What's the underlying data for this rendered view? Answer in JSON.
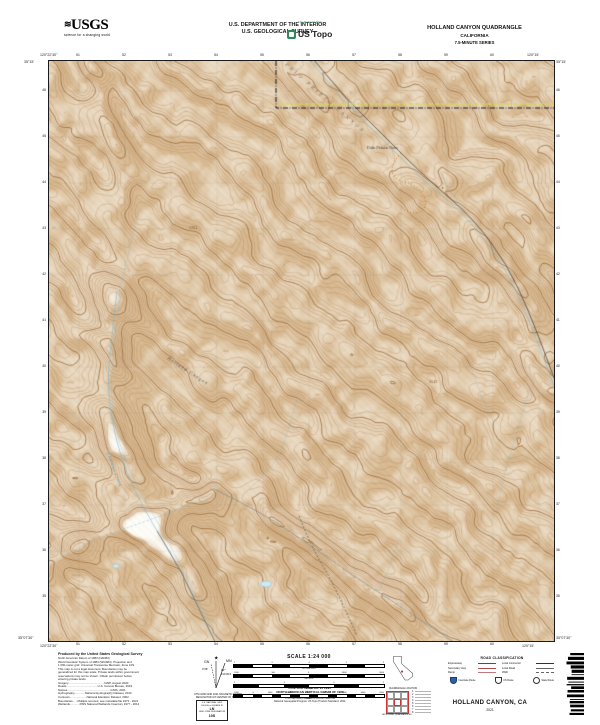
{
  "header": {
    "usgs_logo_text": "USGS",
    "usgs_tagline": "science for a changing world",
    "dept_line1": "U.S. DEPARTMENT OF THE INTERIOR",
    "dept_line2": "U.S. GEOLOGICAL SURVEY",
    "ustopo_brand_top": "The National Map",
    "ustopo_brand": "US Topo",
    "quad_title": "HOLLAND CANYON QUADRANGLE",
    "quad_state": "CALIFORNIA",
    "quad_series": "7.5-MINUTE SERIES"
  },
  "map": {
    "corner_nw_lon": "120°22'30\"",
    "corner_nw_lat": "35°15'",
    "corner_ne_lon": "120°15'",
    "corner_ne_lat": "35°15'",
    "corner_sw_lon": "120°22'30\"",
    "corner_sw_lat": "35°07'30\"",
    "corner_se_lon": "120°15'",
    "corner_se_lat": "35°07'30\"",
    "top_ticks": [
      "51",
      "52",
      "53",
      "54",
      "55",
      "56",
      "57",
      "58",
      "59",
      "60"
    ],
    "bottom_ticks": [
      "51",
      "52",
      "53",
      "54",
      "55",
      "56",
      "57",
      "58",
      "59",
      "60"
    ],
    "left_ticks": [
      "46",
      "45",
      "44",
      "43",
      "42",
      "41",
      "40",
      "39",
      "38",
      "37",
      "36",
      "35"
    ],
    "right_ticks": [
      "46",
      "45",
      "44",
      "43",
      "42",
      "41",
      "40",
      "39",
      "38",
      "37",
      "36",
      "35"
    ],
    "labels": [
      {
        "text": "PALO PRIETO CANYON",
        "x": 236,
        "y": 4,
        "rot": 41,
        "size": 4.2,
        "color": "#6b6b6b",
        "italic": true,
        "spacing": 3
      },
      {
        "text": "Palo Prieto Pass",
        "x": 318,
        "y": 88,
        "rot": 0,
        "size": 3.8,
        "color": "#333333",
        "italic": false,
        "spacing": 0
      },
      {
        "text": "Holland Canyon",
        "x": 118,
        "y": 298,
        "rot": 33,
        "size": 4.2,
        "color": "#555555",
        "italic": true,
        "spacing": 1
      },
      {
        "text": "Cholame Creek",
        "x": 58,
        "y": 392,
        "rot": 70,
        "size": 3.8,
        "color": "#4a88ab",
        "italic": true,
        "spacing": 0.5
      },
      {
        "text": "2113",
        "x": 380,
        "y": 322,
        "rot": 0,
        "size": 3.3,
        "color": "#7a4a22",
        "italic": false,
        "spacing": 0
      },
      {
        "text": "1762",
        "x": 140,
        "y": 168,
        "rot": 0,
        "size": 3.3,
        "color": "#7a4a22",
        "italic": false,
        "spacing": 0
      }
    ]
  },
  "footer": {
    "credits_lines": [
      "Produced by the United States Geological Survey",
      "North American Datum of 1983 (NAD83)",
      "World Geodetic System of 1984 (WGS84). Projection and",
      "1 000-meter grid: Universal Transverse Mercator, Zone 10S",
      "This map is not a legal document. Boundaries may be",
      "generalized for this map scale. Private lands within government",
      "reservations may not be shown. Obtain permission before",
      "entering private lands.",
      "Imagery.............................................NAIP, August 2020",
      "Roads.......................................U.S. Census Bureau, 2019",
      "Names......................................................GNIS, 2021",
      "Hydrography.............National Hydrography Dataset, 2013",
      "Contours.....................National Elevation Dataset, 2002",
      "Boundaries......Multiple sources; see metadata file 1972 - 2021",
      "Wetlands............FWS National Wetlands Inventory 1977 - 2014"
    ],
    "declination": {
      "star": "★",
      "mn_label": "MN",
      "mn_angle": "12°",
      "mn_mils": "213 MILS",
      "gn_label": "GN",
      "gn_angle": "0°28'",
      "caption1": "UTM GRID AND 2021 MAGNETIC NORTH",
      "caption2": "DECLINATION AT CENTER OF SHEET"
    },
    "usng": {
      "title1": "U.S. NATIONAL GRID",
      "title2": "100,000-m SQUARE ID",
      "square_id": "LN",
      "zone_label": "GRID ZONE DESIGNATION",
      "zone": "10S"
    },
    "scale": {
      "title": "SCALE 1:24 000",
      "bars": [
        {
          "unit": "KILOMETERS",
          "ticks": [
            "1",
            ".5",
            "0",
            "1",
            "2"
          ]
        },
        {
          "unit": "METERS",
          "ticks": [
            "1000",
            "500",
            "0",
            "1000",
            "2000"
          ]
        },
        {
          "unit": "MILES",
          "ticks": [
            "1",
            ".5",
            "0",
            "1"
          ]
        },
        {
          "unit": "FEET",
          "ticks": [
            "1000",
            "0",
            "1000",
            "2000",
            "3000",
            "4000",
            "5000",
            "6000",
            "7000"
          ]
        }
      ],
      "ci1": "CONTOUR INTERVAL 20 FEET",
      "ci2": "NORTH AMERICAN VERTICAL DATUM OF 1988",
      "std1": "This map was produced to conform with the",
      "std2": "National Geospatial Program US Topo Product Standard, 2011."
    },
    "location": {
      "state_caption": "QUADRANGLE LOCATION",
      "adjoining_caption": "ADJOINING QUADRANGLES",
      "adjoining_numbers": [
        "1",
        "2",
        "3",
        "4",
        "5",
        "6",
        "7",
        "8"
      ]
    },
    "roads": {
      "title": "ROAD CLASSIFICATION",
      "rows": [
        {
          "left_label": "Expressway",
          "left_style": "expressway",
          "right_label": "Local Connector",
          "right_style": "connector"
        },
        {
          "left_label": "Secondary Hwy",
          "left_style": "secondary",
          "right_label": "Local Road",
          "right_style": "local"
        },
        {
          "left_label": "Ramp",
          "left_style": "ramp",
          "right_label": "4WD",
          "right_style": "fwd"
        }
      ],
      "shields": [
        {
          "type": "interstate",
          "label": "Interstate Route"
        },
        {
          "type": "us",
          "label": "US Route"
        },
        {
          "type": "state",
          "label": "State Route"
        }
      ]
    },
    "sheet_title": {
      "name": "HOLLAND CANYON,  CA",
      "year": "2021"
    },
    "colors": {
      "contour": "#b27c4a",
      "water": "#7db5d2",
      "boundary_yellow": "#d6d94f",
      "road_red": "#9e2f2f"
    }
  }
}
